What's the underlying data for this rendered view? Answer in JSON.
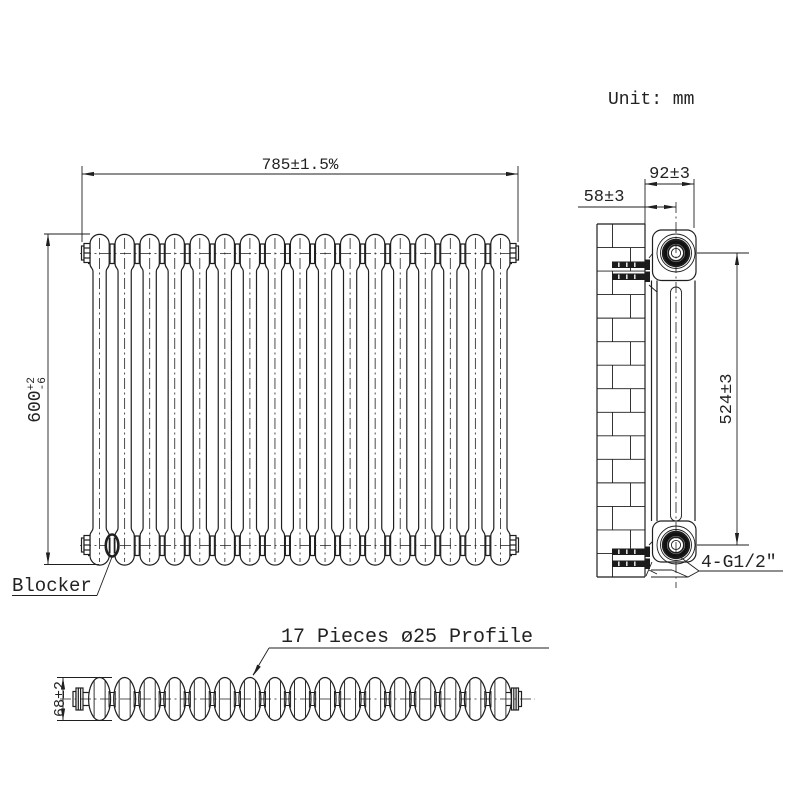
{
  "drawing_meta": {
    "unit_note": "Unit: mm"
  },
  "front_view": {
    "width_dim": "785±1.5%",
    "height_dim": {
      "value": "600",
      "tol_upper": "+2",
      "tol_lower": "-6"
    },
    "blocker_label": "Blocker"
  },
  "side_view": {
    "overall_depth_dim": "92±3",
    "wall_to_center_dim": "58±3",
    "port_center_dim": "524±3",
    "ports_label": "4-G1/2″"
  },
  "top_view": {
    "columns_label": "17 Pieces ø25 Profile",
    "depth_dim": "68±2"
  },
  "geometry": {
    "column_count": 17
  },
  "style": {
    "line_color": "#1f1f1f",
    "bg_color": "#ffffff"
  }
}
